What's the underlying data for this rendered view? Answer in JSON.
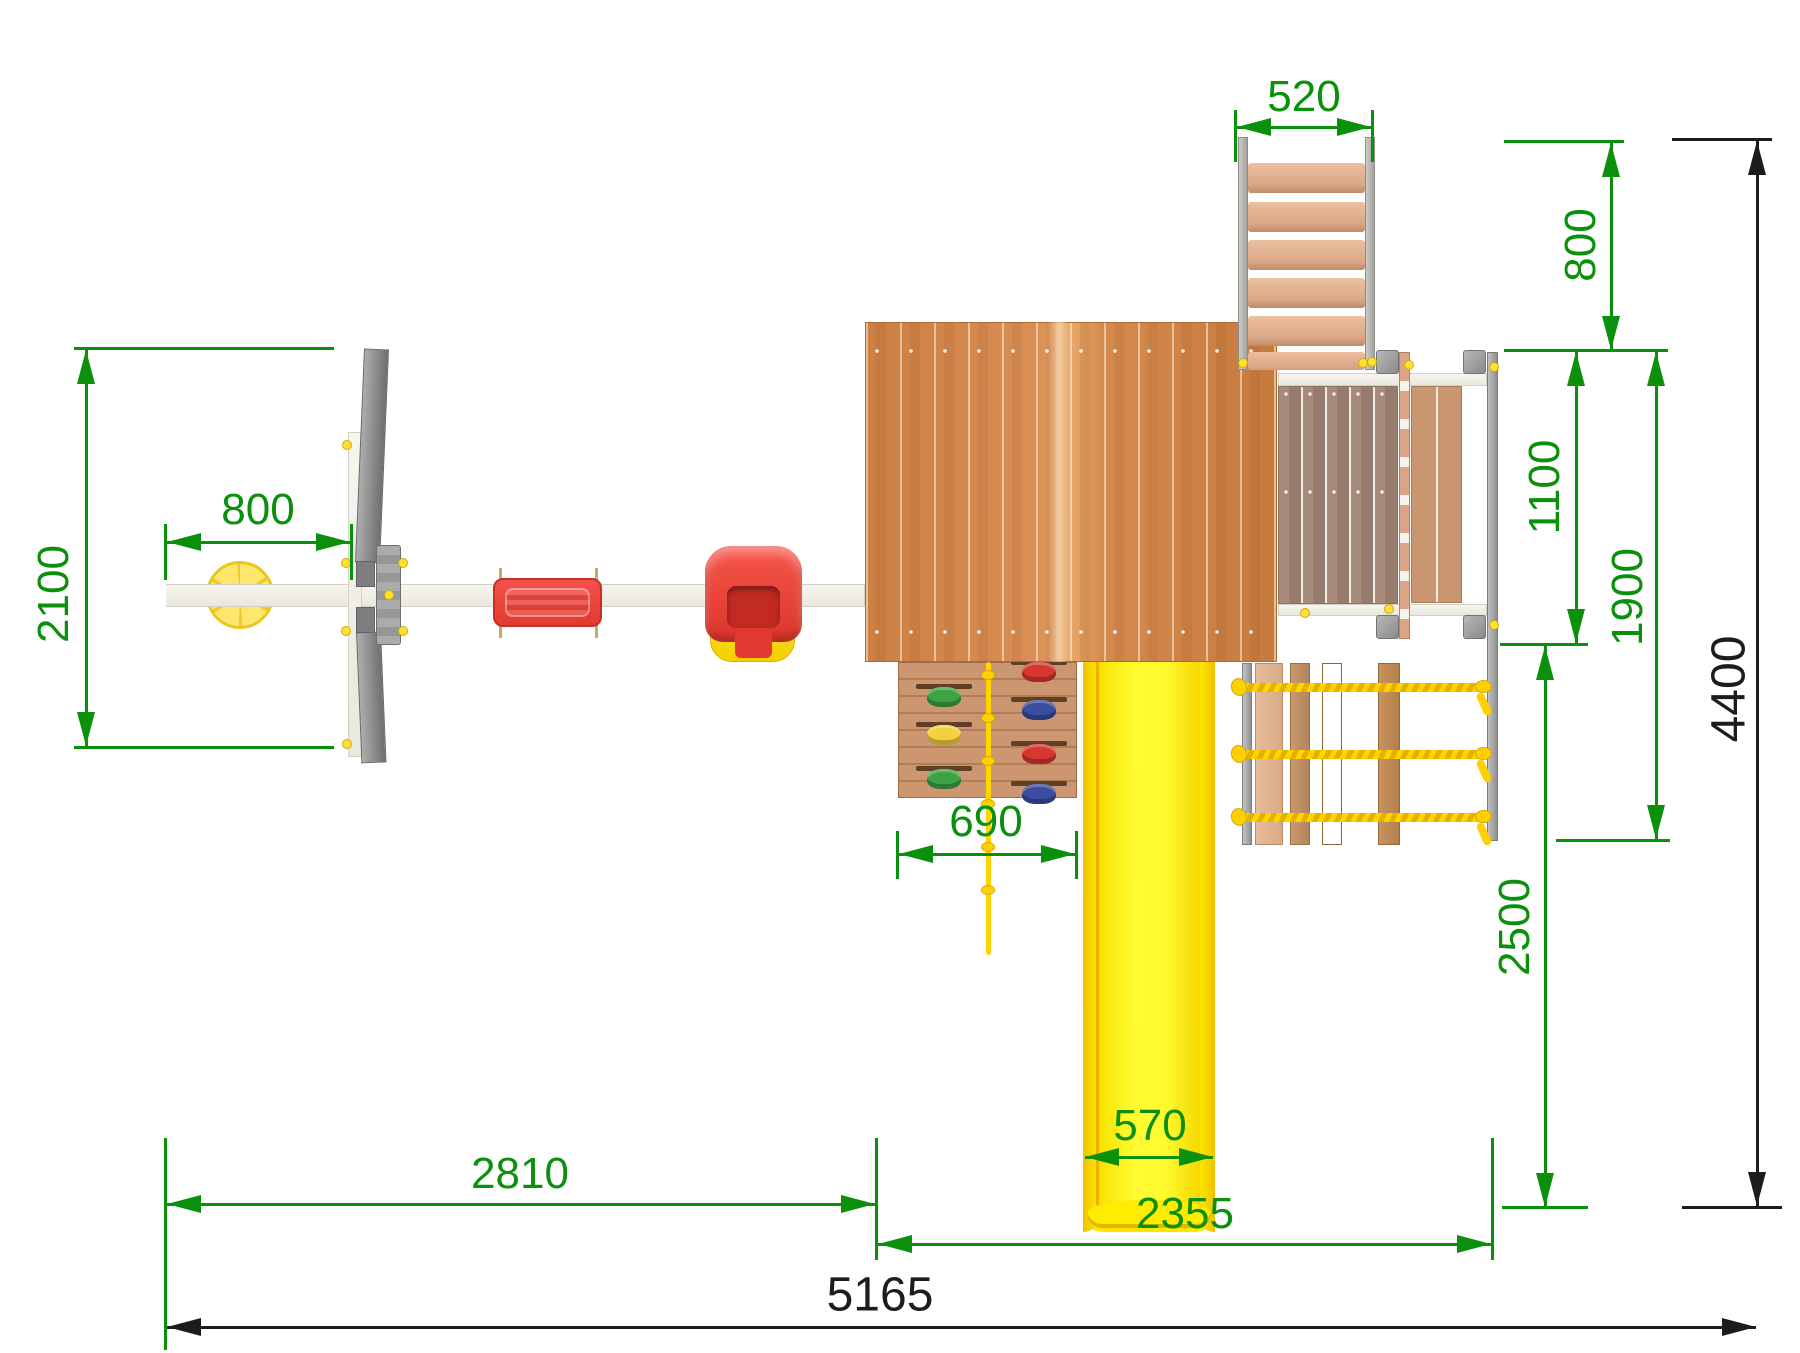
{
  "drawing": {
    "type": "playground-top-view-dimension-drawing",
    "units_implied": "mm"
  },
  "colors": {
    "dimension_green": "#0b900b",
    "dimension_black": "#1c1c1c",
    "slide_yellow": "#ffe500",
    "rope_yellow": "#ffd400",
    "swing_red": "#ee4038",
    "frame_gray": "#8b8b8b",
    "beam_white": "#f4f2ec",
    "roof_wood": "#cf8448",
    "deck_wood": "#9d8071"
  },
  "dims": {
    "d520": "520",
    "d800_left": "800",
    "d2100": "2100",
    "d690": "690",
    "d570": "570",
    "d800_right": "800",
    "d1100": "1100",
    "d1900": "1900",
    "d2500": "2500",
    "d4400": "4400",
    "d2810": "2810",
    "d2355": "2355",
    "d5165": "5165"
  }
}
